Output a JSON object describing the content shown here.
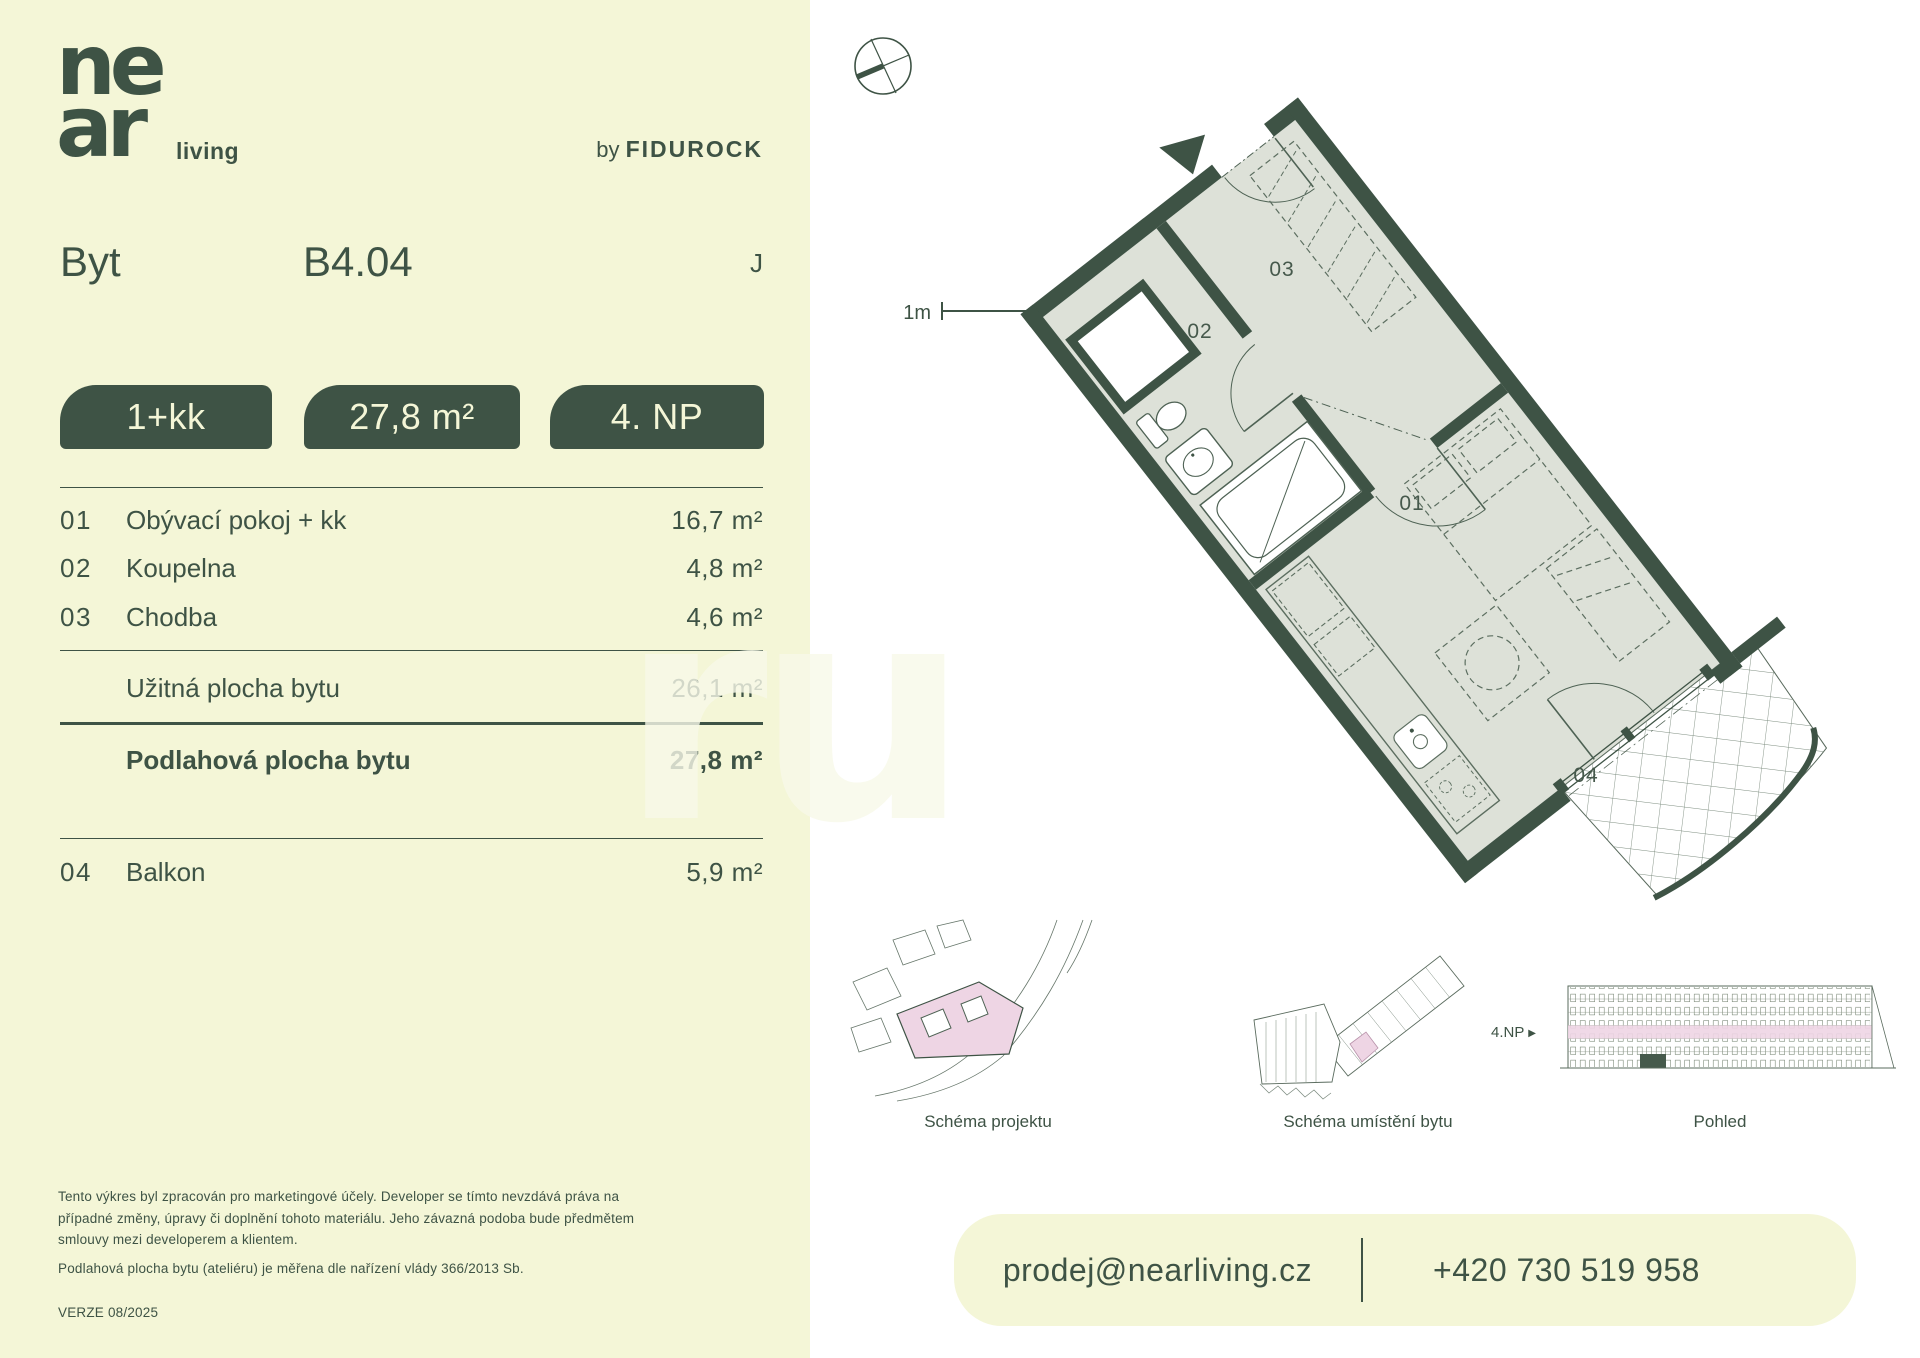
{
  "brand": {
    "logo_line1": "ne",
    "logo_line2": "ar",
    "logo_suffix": "living",
    "byline_prefix": "by ",
    "byline_brand": "FIDUROCK"
  },
  "header": {
    "unit_label": "Byt",
    "unit_number": "B4.04",
    "type_letter": "J"
  },
  "badges": [
    {
      "label": "1+kk"
    },
    {
      "label": "27,8 m²"
    },
    {
      "label": "4. NP"
    }
  ],
  "rooms": [
    {
      "code": "01",
      "name": "Obývací pokoj + kk",
      "area": "16,7 m²"
    },
    {
      "code": "02",
      "name": "Koupelna",
      "area": "4,8 m²"
    },
    {
      "code": "03",
      "name": "Chodba",
      "area": "4,6 m²"
    }
  ],
  "summary": [
    {
      "name": "Užitná plocha bytu",
      "area": "26,1 m²"
    },
    {
      "name": "Podlahová plocha bytu",
      "area": "27,8 m²"
    }
  ],
  "extras": [
    {
      "code": "04",
      "name": "Balkon",
      "area": "5,9 m²"
    }
  ],
  "plan": {
    "scale_label": "1m",
    "room_labels": [
      "01",
      "02",
      "03",
      "04"
    ]
  },
  "schematics": [
    {
      "caption": "Schéma projektu"
    },
    {
      "caption": "Schéma umístění bytu"
    },
    {
      "caption": "Pohled",
      "floor_label": "4.NP"
    }
  ],
  "footer": {
    "disclaimer1": "Tento výkres byl zpracován pro marketingové účely. Developer se tímto nevzdává práva na případné změny, úpravy či doplnění tohoto materiálu. Jeho závazná podoba bude předmětem smlouvy mezi developerem a klientem.",
    "disclaimer2": "Podlahová plocha bytu (ateliéru) je měřena dle nařízení vlády 366/2013 Sb.",
    "version": "VERZE 08/2025"
  },
  "contact": {
    "email": "prodej@nearliving.cz",
    "phone": "+420 730 519 958"
  },
  "colors": {
    "cream": "#f4f6d7",
    "green": "#3e5345",
    "floor": "#dde1d8",
    "pink": "#eed5e4"
  }
}
